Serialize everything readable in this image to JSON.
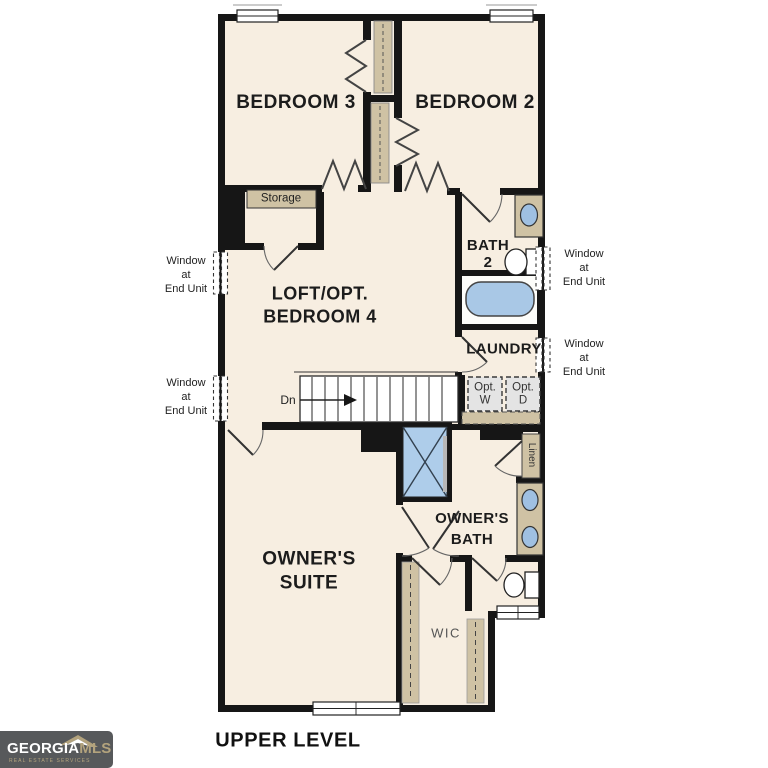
{
  "rooms": {
    "bedroom3": "BEDROOM 3",
    "bedroom2": "BEDROOM 2",
    "loft_line1": "LOFT/OPT.",
    "loft_line2": "BEDROOM 4",
    "bath2_line1": "BATH",
    "bath2_line2": "2",
    "laundry": "LAUNDRY",
    "owners_suite_line1": "OWNER'S",
    "owners_suite_line2": "SUITE",
    "owners_bath_line1": "OWNER'S",
    "owners_bath_line2": "BATH",
    "wic": "WIC"
  },
  "annotations": {
    "storage": "Storage",
    "linen": "Linen",
    "down": "Dn",
    "opt_washer_line1": "Opt.",
    "opt_washer_line2": "W",
    "opt_dryer_line1": "Opt.",
    "opt_dryer_line2": "D",
    "window_note_line1": "Window",
    "window_note_line2": "at",
    "window_note_line3": "End Unit"
  },
  "footer": {
    "level_label": "UPPER LEVEL"
  },
  "logo": {
    "brand_part1": "GEORGIA",
    "brand_part2": "MLS",
    "tagline": "REAL ESTATE SERVICES"
  },
  "colors": {
    "wall": "#161616",
    "floor": "#f7eee1",
    "casework_tan": "#cfc2a4",
    "fixture_blue": "#a9c8e6",
    "sink_blue": "#9fc0e2",
    "appliance_gray": "#e4e4e4",
    "logo_background": "#57595b",
    "logo_gold": "#b3a37d"
  }
}
